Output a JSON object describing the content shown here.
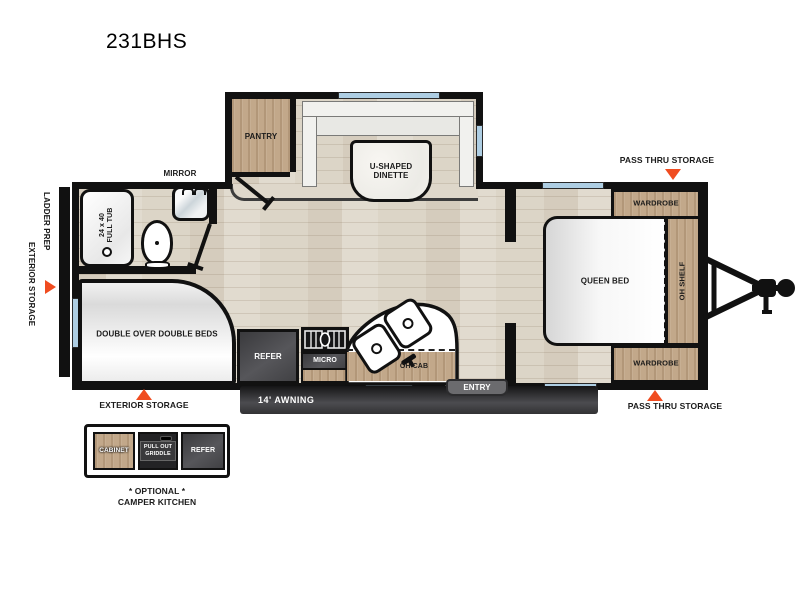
{
  "title": "231BHS",
  "exterior": {
    "ladder_prep": "LADDER PREP",
    "exterior_storage_left": "EXTERIOR STORAGE",
    "exterior_storage_bottom": "EXTERIOR STORAGE",
    "pass_thru_storage_top": "PASS THRU STORAGE",
    "pass_thru_storage_bottom": "PASS THRU STORAGE",
    "awning": "14' AWNING",
    "entry": "ENTRY"
  },
  "rooms": {
    "pantry": "PANTRY",
    "dinette": {
      "line1": "U-SHAPED",
      "line2": "DINETTE"
    },
    "tub": {
      "line1": "24 x 40",
      "line2": "FULL TUB"
    },
    "mirror": "MIRROR",
    "double_beds": "DOUBLE OVER DOUBLE BEDS",
    "refer": "REFER",
    "micro": "MICRO",
    "oh_cab": "OH CAB",
    "queen_bed": "QUEEN BED",
    "oh_shelf": "OH SHELF",
    "wardrobe_top": "WARDROBE",
    "wardrobe_bottom": "WARDROBE"
  },
  "camper_kitchen": {
    "cabinet": "CABINET",
    "griddle": {
      "line1": "PULL OUT",
      "line2": "GRIDDLE"
    },
    "refer": "REFER",
    "caption_line1": "* OPTIONAL *",
    "caption_line2": "CAMPER KITCHEN"
  },
  "colors": {
    "accent_orange": "#F04C20",
    "wood_cabinet": "#C2A88A",
    "floor": "#DCD5C7",
    "window_blue": "#AECEE3",
    "wall_black": "#111111",
    "appliance_dark": "#47474A"
  }
}
